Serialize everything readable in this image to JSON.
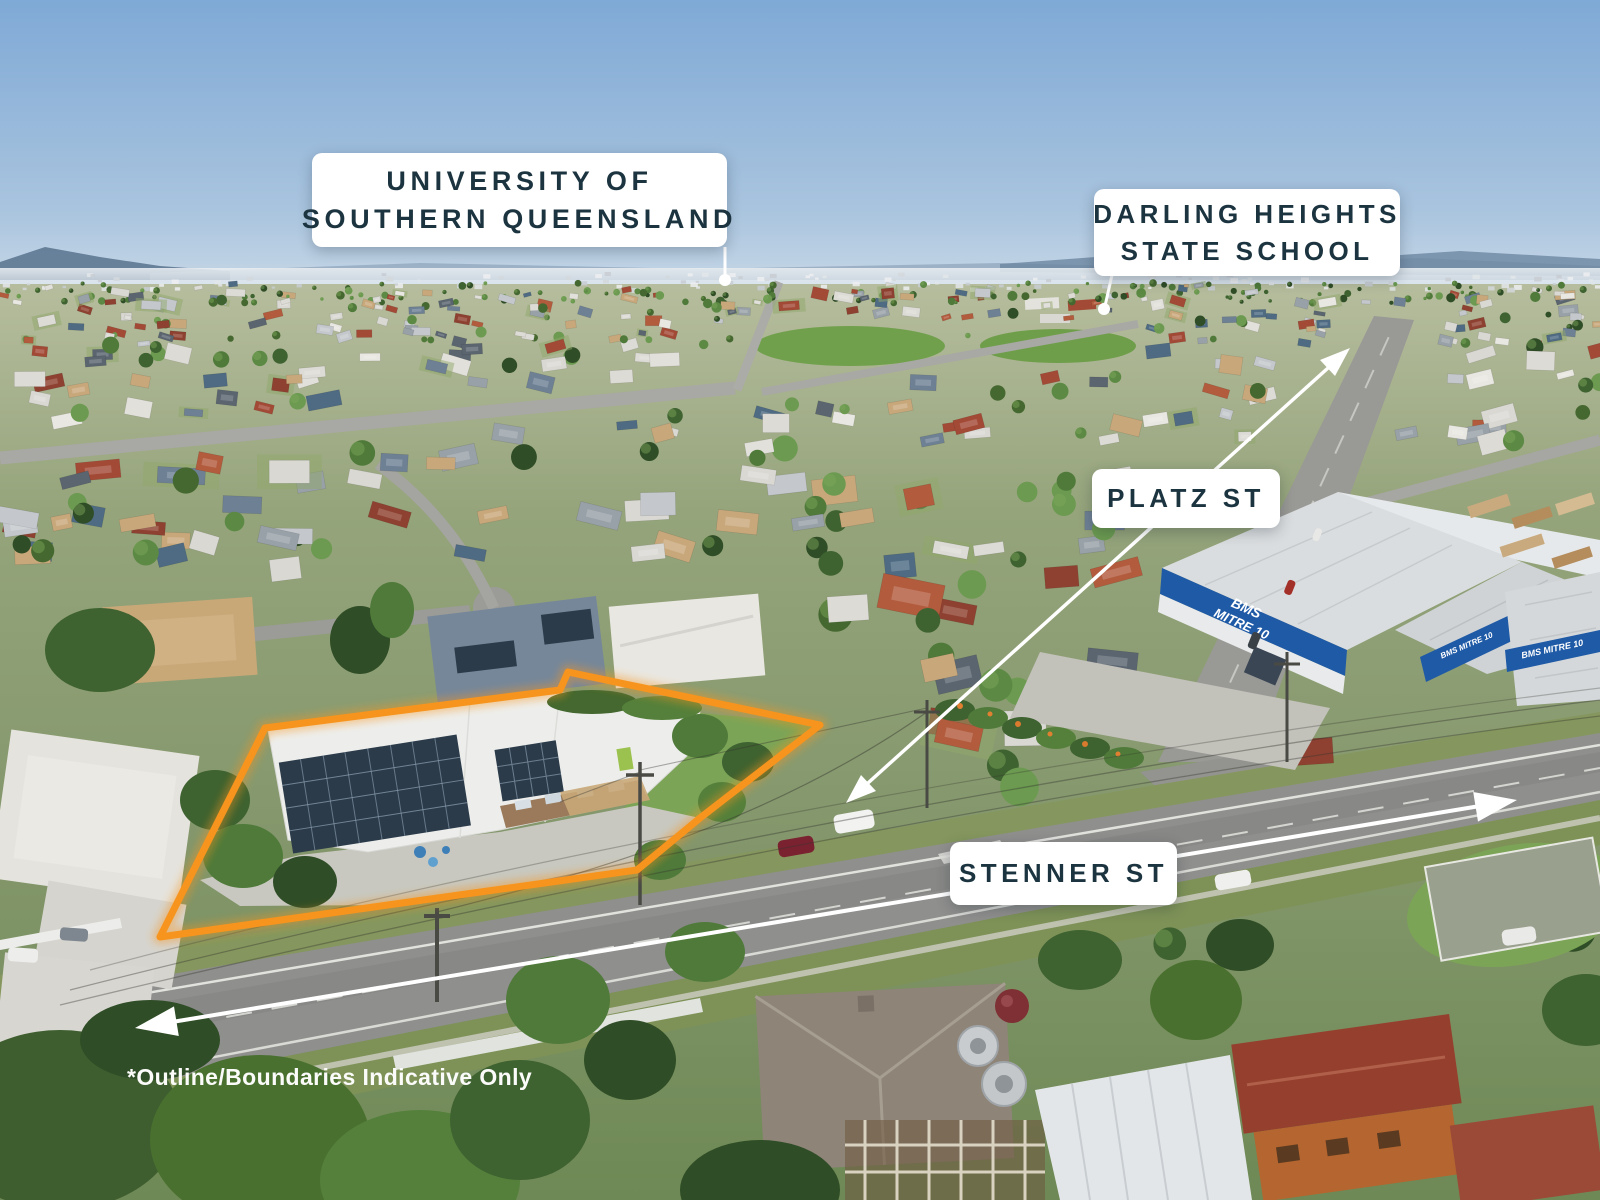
{
  "photo": {
    "type": "aerial-suburb-drone-photo",
    "description": "Oblique aerial view of Darling Heights suburb with subject property outlined in orange at an intersection of Stenner St and Platz St, BMS Mitre 10 warehouse opposite",
    "landmarks": {
      "warehouse_sign_top": "BMS",
      "warehouse_sign_bottom": "MITRE 10",
      "warehouse_sign_combined": "BMS MITRE 10"
    }
  },
  "annotations": {
    "accent_color": "#F7941E",
    "label_text_color": "#1B3440",
    "label_bg_color": "#FFFFFF",
    "labels": [
      {
        "id": "usq",
        "line1": "UNIVERSITY OF",
        "line2": "SOUTHERN QUEENSLAND"
      },
      {
        "id": "school",
        "line1": "DARLING HEIGHTS",
        "line2": "STATE SCHOOL"
      },
      {
        "id": "platz",
        "line1": "PLATZ ST",
        "line2": ""
      },
      {
        "id": "stenner",
        "line1": "STENNER ST",
        "line2": ""
      }
    ],
    "disclaimer": "*Outline/Boundaries Indicative Only"
  }
}
